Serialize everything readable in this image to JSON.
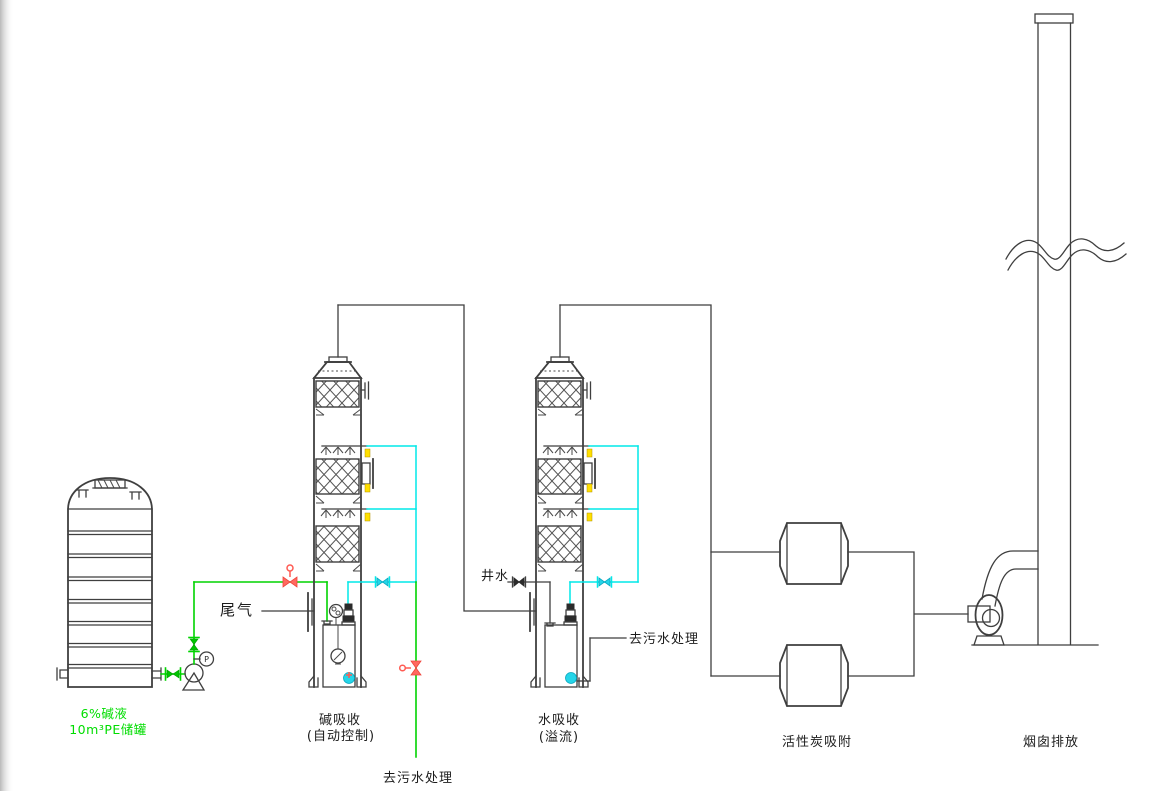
{
  "diagram": {
    "type": "process-flow-diagram",
    "background": "#ffffff",
    "colors": {
      "line": "#3f3f3f",
      "alkali_pipe_green": "#00d400",
      "spray_pipe_cyan": "#00e8e8",
      "valve_red": "#ff5a52",
      "tick_yellow": "#ffdf00",
      "label_green": "#00dd00",
      "label_black": "#1c1c1c"
    },
    "labels": {
      "tank_line1": "6%碱液",
      "tank_line2": "10m³PE储罐",
      "tail_gas": "尾气",
      "well_water": "井水",
      "to_wastewater_bottom": "去污水处理",
      "to_wastewater_right": "去污水处理",
      "tower1_name": "碱吸收",
      "tower1_mode": "(自动控制)",
      "tower2_name": "水吸收",
      "tower2_mode": "(溢流)",
      "carbon_unit": "活性炭吸附",
      "stack": "烟囱排放",
      "pressure_gauge": "P"
    },
    "equipment": [
      "pe-storage-tank",
      "alkali-feed-pump",
      "alkali-absorption-tower",
      "water-absorption-tower",
      "activated-carbon-adsorber-top",
      "activated-carbon-adsorber-bottom",
      "exhaust-fan",
      "chimney"
    ]
  }
}
